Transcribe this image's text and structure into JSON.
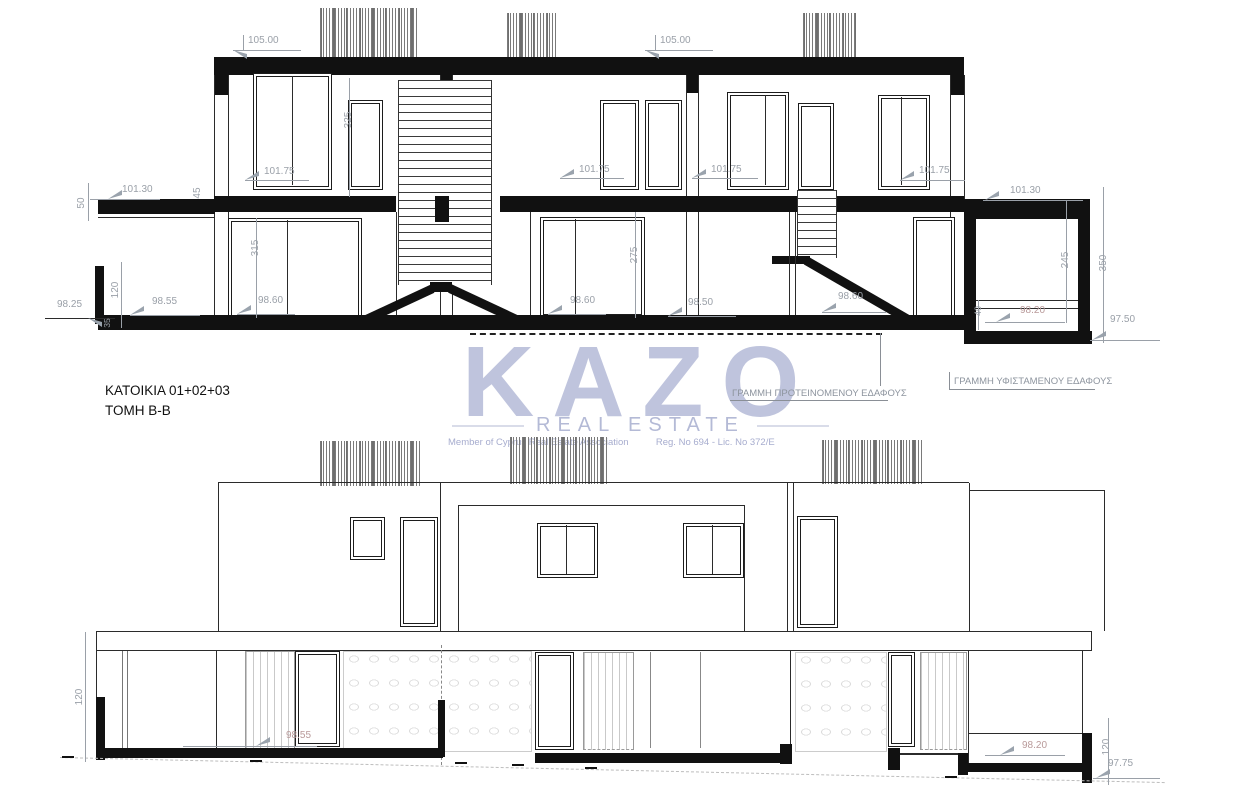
{
  "title_block": {
    "line1": "ΚΑΤΟΙΚΙΑ 01+02+03",
    "line2": "ΤΟΜΗ Β-Β"
  },
  "watermark": {
    "brand": "KAZO",
    "tagline": "REAL ESTATE",
    "member_text": "Member of Cyprus Real Estate Association",
    "registration_text": "Reg. No 694 - Lic. No 372/E",
    "logo_color": "#aeb6d3"
  },
  "annotations": {
    "proposed_ground_line": "ΓΡΑΜΜΗ ΠΡΟΤΕΙΝΟΜΕΝΟΥ ΕΔΑΦΟΥΣ",
    "existing_ground_line": "ΓΡΑΜΜΗ ΥΦΙΣΤΑΜΕΝΟΥ ΕΔΑΦΟΥΣ"
  },
  "section_drawing": {
    "roof_dims": [
      "105.00",
      "105.00"
    ],
    "upper_floor_levels": [
      "101.75",
      "101.75",
      "101.75",
      "101.75"
    ],
    "canopy_levels": [
      "101.30",
      "101.30"
    ],
    "ground_levels": [
      "98.25",
      "98.55",
      "98.60",
      "98.60",
      "98.50",
      "98.60",
      "98.20",
      "97.50"
    ],
    "vertical_dims": [
      "50",
      "45",
      "325",
      "315",
      "120",
      "35",
      "275",
      "245",
      "350",
      "40"
    ]
  },
  "elevation_drawing": {
    "levels": [
      "98.55",
      "98.20",
      "97.75"
    ],
    "vertical_dims": [
      "120",
      "120"
    ]
  }
}
